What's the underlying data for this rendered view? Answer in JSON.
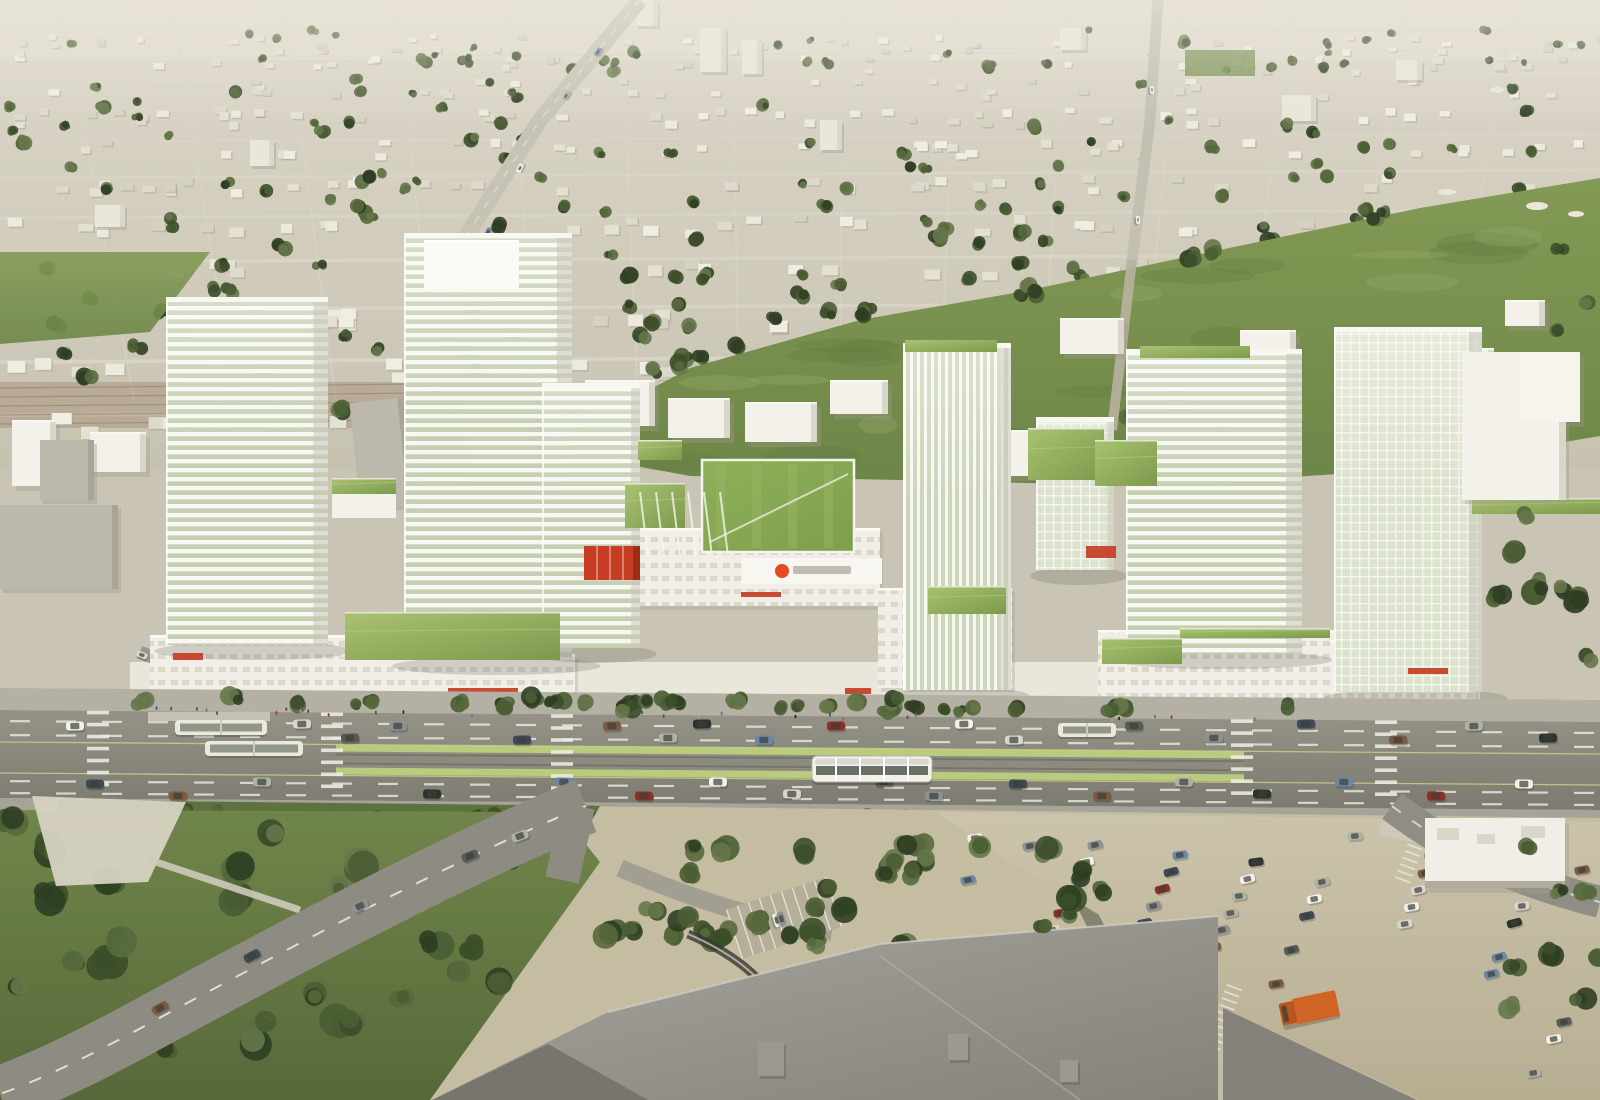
{
  "scene": {
    "description": "Aerial architectural rendering of a proposed transit-oriented mixed-use development: white wireframe towers with green roofs along an arterial road with a light-rail median, suburban fabric and greenbelt behind, surface parking and a large mall roof in the foreground",
    "width": 1600,
    "height": 1100
  },
  "palette": {
    "horizon": "#e0dbcd",
    "suburb_top": "#dcd7c9",
    "suburb_bottom": "#c7c2b0",
    "street": "#d9d5c7",
    "house_fills": [
      "#eceadd",
      "#e4e1d2",
      "#dedacb",
      "#f0eee2",
      "#d6d2c2"
    ],
    "house_shadow": "#a39d8e",
    "tree_greens": [
      "#2f3e22",
      "#3c4e2a",
      "#4a5d33",
      "#57693c",
      "#65774a"
    ],
    "field_top": "#839a55",
    "field_bottom": "#6d8547",
    "field_mottle_dark": "#5f7a3e",
    "field_mottle_light": "#95aa66",
    "bunker": "#eae7d9",
    "white_building": "#f3f1ea",
    "building_shade": "#d9d6ca",
    "building_shadow": "#9f9a8b",
    "gray_slab": "#bcb8ac",
    "rowhouse_brown": "#9b8068",
    "frame_white": "#f8f7f2",
    "glass_band": "#c5d0b2",
    "glass_band_v": "#ccd6ba",
    "glass_grid_bg": "#dce3cc",
    "podium_window": "#dbd7c9",
    "green_roof_light": "#a9c272",
    "green_roof_dark": "#7d9a4c",
    "lawn_bright": "#86a654",
    "lawn_stripe": "#97b563",
    "accent_red": "#c63d24",
    "logo_red": "#e8481f",
    "logo_text_gray": "#b9b6ac",
    "sidewalk": "#b4b1a4",
    "road_top": "#959387",
    "road_bottom": "#7d7b71",
    "lane_dash": "#edebe0",
    "lane_yellow": "#cdd287",
    "median_green": "#b9cb7e",
    "track_dark": "#76746a",
    "tram_body": "#f2f1ec",
    "tram_window": "#6b7066",
    "bus_body": "#ebe9dc",
    "car_colors": [
      "#f2f1ea",
      "#d8d6cc",
      "#5a5c58",
      "#8e9193",
      "#3f4a56",
      "#7e5a42",
      "#aeb3a6",
      "#2e3330",
      "#6b89a6",
      "#8c2f24"
    ],
    "people_colors": [
      "#555550",
      "#77736b",
      "#8c3a30",
      "#3a5a78",
      "#a8a49a",
      "#2e2c28"
    ],
    "park_top": "#70854a",
    "park_bottom": "#57693a",
    "plaza": "#d7d2c2",
    "ground_tan": "#c5bda2",
    "parking_light": "#cbc4ab",
    "parking_dark": "#b7ae92",
    "stall_line": "#efece0",
    "mall_roof_light": "#a8a59e",
    "mall_roof_dark": "#84827b",
    "mall_roof_darker": "#77756e",
    "truck_orange": "#d06427",
    "truck_cab": "#b9551e",
    "retail_roof": "#f0eee6",
    "shadow": "#5c5a4e"
  },
  "suburb": {
    "seed": 11,
    "h_streets": [
      38,
      58,
      82,
      110,
      142,
      178,
      218,
      262,
      310,
      362,
      415
    ],
    "v_street_spacing": 112,
    "house_count": 430,
    "tree_count": 250,
    "arterial": "M640,0 L540,120 L470,230 L430,310",
    "north_road": "M1158,0 L1150,120 L1132,260 L1112,430",
    "slabs": [
      [
        700,
        28,
        26,
        44
      ],
      [
        742,
        40,
        20,
        34
      ],
      [
        250,
        140,
        24,
        26
      ],
      [
        95,
        205,
        30,
        22
      ],
      [
        636,
        0,
        22,
        26
      ],
      [
        1282,
        95,
        34,
        26
      ],
      [
        1396,
        60,
        26,
        20
      ],
      [
        820,
        120,
        22,
        30
      ],
      [
        1060,
        28,
        26,
        22
      ]
    ],
    "rowhouse_band": [
      0,
      382,
      430,
      46
    ],
    "arterial_cars": [
      [
        598,
        52
      ],
      [
        566,
        96
      ],
      [
        520,
        168
      ],
      [
        488,
        232
      ]
    ],
    "north_road_cars": [
      [
        1152,
        90
      ],
      [
        1138,
        220
      ]
    ]
  },
  "greenfield": {
    "main_poly": [
      [
        540,
        448
      ],
      [
        690,
        368
      ],
      [
        860,
        320
      ],
      [
        1020,
        292
      ],
      [
        1210,
        252
      ],
      [
        1420,
        208
      ],
      [
        1600,
        178
      ],
      [
        1600,
        436
      ],
      [
        1400,
        470
      ],
      [
        1150,
        486
      ],
      [
        900,
        480
      ],
      [
        690,
        476
      ]
    ],
    "left_poly": [
      [
        0,
        252
      ],
      [
        210,
        252
      ],
      [
        150,
        332
      ],
      [
        0,
        344
      ]
    ],
    "bunkers": [
      [
        1447,
        192,
        9,
        3
      ],
      [
        1537,
        206,
        11,
        4
      ],
      [
        1576,
        214,
        8,
        3
      ],
      [
        1497,
        90,
        7,
        3
      ]
    ],
    "mottle_seed": 5,
    "tree_line": [
      [
        560,
        430
      ],
      [
        700,
        360
      ],
      [
        860,
        316
      ],
      [
        1030,
        288
      ],
      [
        1200,
        254
      ],
      [
        1380,
        218
      ]
    ],
    "inner_clusters": [
      [
        1080,
        430
      ],
      [
        1130,
        415
      ],
      [
        1180,
        400
      ],
      [
        1215,
        425
      ],
      [
        1560,
        250
      ],
      [
        1585,
        300
      ],
      [
        1560,
        330
      ],
      [
        1100,
        455
      ]
    ],
    "park_patch": [
      1185,
      50,
      70,
      26
    ]
  },
  "campus": {
    "white_buildings": [
      [
        585,
        380,
        70,
        46
      ],
      [
        668,
        398,
        62,
        40
      ],
      [
        745,
        402,
        72,
        40
      ],
      [
        830,
        380,
        58,
        34
      ],
      [
        925,
        352,
        66,
        34
      ],
      [
        1000,
        430,
        70,
        46
      ],
      [
        1060,
        318,
        64,
        36
      ],
      [
        1240,
        330,
        56,
        30
      ],
      [
        1430,
        348,
        64,
        52
      ],
      [
        1505,
        300,
        40,
        26
      ],
      [
        90,
        432,
        56,
        40
      ],
      [
        12,
        420,
        44,
        66
      ],
      [
        1520,
        352,
        60,
        70
      ]
    ],
    "gray_slabs": [
      [
        355,
        400,
        54,
        108
      ],
      [
        418,
        396,
        46,
        96
      ],
      [
        0,
        505,
        118,
        84
      ],
      [
        40,
        440,
        54,
        60
      ]
    ]
  },
  "development": {
    "towers": [
      {
        "id": "tower-1",
        "x": 166,
        "y": 300,
        "w": 162,
        "h": 345,
        "style": "h"
      },
      {
        "id": "tower-2",
        "x": 404,
        "y": 236,
        "w": 168,
        "h": 424,
        "style": "h",
        "parapet": [
          424,
          240,
          95,
          48
        ]
      },
      {
        "id": "tower-3",
        "x": 542,
        "y": 386,
        "w": 98,
        "h": 262,
        "style": "h"
      },
      {
        "id": "tower-4",
        "x": 903,
        "y": 346,
        "w": 108,
        "h": 344,
        "style": "v",
        "cap": [
          905,
          340,
          92,
          12
        ]
      },
      {
        "id": "tower-5",
        "x": 1036,
        "y": 420,
        "w": 78,
        "h": 150,
        "style": "grid"
      },
      {
        "id": "tower-6",
        "x": 1126,
        "y": 352,
        "w": 176,
        "h": 302,
        "style": "h",
        "cap": [
          1140,
          346,
          110,
          12
        ]
      },
      {
        "id": "tower-7",
        "x": 1334,
        "y": 330,
        "w": 148,
        "h": 362,
        "style": "grid"
      }
    ],
    "podiums": [
      [
        150,
        635,
        205,
        70
      ],
      [
        340,
        654,
        235,
        50
      ],
      [
        628,
        528,
        252,
        78
      ],
      [
        878,
        588,
        134,
        100
      ],
      [
        1098,
        630,
        238,
        72
      ],
      [
        1330,
        640,
        145,
        60
      ]
    ],
    "green_roofs": [
      [
        332,
        478,
        64,
        16
      ],
      [
        345,
        612,
        215,
        48
      ],
      [
        625,
        483,
        60,
        45
      ],
      [
        638,
        440,
        44,
        20
      ],
      [
        928,
        586,
        78,
        28
      ],
      [
        1102,
        638,
        80,
        26
      ],
      [
        1180,
        628,
        150,
        10
      ],
      [
        1472,
        498,
        128,
        16
      ],
      [
        1028,
        428,
        76,
        52
      ],
      [
        1095,
        440,
        62,
        46
      ]
    ],
    "small_green_bldg": [
      332,
      478,
      64,
      40
    ],
    "lawn_main": [
      702,
      460,
      152,
      92
    ],
    "annex": [
      1462,
      352,
      104,
      148
    ],
    "annex2": [
      1520,
      352,
      60,
      70
    ],
    "logo": {
      "cx": 782,
      "cy": 571,
      "r": 7,
      "bar": [
        793,
        566,
        58,
        8
      ]
    },
    "facade_band": [
      742,
      558,
      140,
      26
    ],
    "red_canopy": [
      584,
      546,
      56,
      34
    ],
    "red_signs": [
      [
        173,
        653,
        30,
        7
      ],
      [
        448,
        688,
        70,
        6
      ],
      [
        845,
        688,
        26,
        6
      ],
      [
        1086,
        546,
        30,
        12
      ],
      [
        1408,
        668,
        40,
        6
      ],
      [
        741,
        592,
        40,
        5
      ]
    ],
    "street_trees": {
      "seed": 21,
      "count": 42,
      "x1": 140,
      "x2": 1390,
      "y": 700
    },
    "people": {
      "seed": 22,
      "count": 30,
      "x1": 150,
      "x2": 1380,
      "y": 706
    },
    "local_street": "M140,652 L258,702"
  },
  "road": {
    "sidewalk_north": [
      [
        0,
        688
      ],
      [
        1600,
        700
      ],
      [
        1600,
        722
      ],
      [
        0,
        710
      ]
    ],
    "band": [
      [
        0,
        710
      ],
      [
        1600,
        722
      ],
      [
        1600,
        810
      ],
      [
        0,
        798
      ]
    ],
    "sidewalk_south": [
      [
        0,
        798
      ],
      [
        1600,
        810
      ],
      [
        1600,
        822
      ],
      [
        0,
        810
      ]
    ],
    "median": {
      "x": 336,
      "y": 748,
      "w": 908,
      "h": 30,
      "tilt": 0.0075
    },
    "crosswalk_xs": [
      98,
      332,
      562,
      1242,
      1386
    ],
    "dash_rows": [
      726,
      740,
      786,
      798
    ],
    "yellow_lines": [
      748,
      779
    ],
    "cars_west": [
      [
        75,
        726
      ],
      [
        302,
        724
      ],
      [
        350,
        738
      ],
      [
        398,
        726
      ],
      [
        522,
        740
      ],
      [
        612,
        726
      ],
      [
        668,
        738
      ],
      [
        702,
        724
      ],
      [
        764,
        740
      ],
      [
        836,
        726
      ],
      [
        964,
        724
      ],
      [
        1014,
        740
      ],
      [
        1134,
        726
      ],
      [
        1214,
        738
      ],
      [
        1306,
        724
      ],
      [
        1398,
        740
      ],
      [
        1474,
        726
      ],
      [
        1548,
        738
      ]
    ],
    "cars_east": [
      [
        95,
        784
      ],
      [
        178,
        796
      ],
      [
        262,
        782
      ],
      [
        432,
        794
      ],
      [
        564,
        782
      ],
      [
        644,
        796
      ],
      [
        718,
        782
      ],
      [
        792,
        794
      ],
      [
        884,
        782
      ],
      [
        934,
        796
      ],
      [
        1018,
        784
      ],
      [
        1102,
        796
      ],
      [
        1184,
        782
      ],
      [
        1262,
        794
      ],
      [
        1344,
        782
      ],
      [
        1436,
        796
      ],
      [
        1524,
        784
      ]
    ],
    "tram": {
      "x": 812,
      "y": 756,
      "w": 120,
      "h": 26,
      "segments": 5
    },
    "buses": [
      [
        175,
        720,
        92,
        15
      ],
      [
        205,
        741,
        98,
        15
      ],
      [
        1058,
        723,
        58,
        14
      ]
    ],
    "platform": [
      148,
      712,
      122,
      9
    ]
  },
  "south_band": {
    "poly": [
      [
        58,
        800
      ],
      [
        620,
        806
      ],
      [
        1118,
        816
      ],
      [
        1118,
        840
      ],
      [
        620,
        832
      ],
      [
        58,
        828
      ]
    ],
    "tree_seed": 31,
    "tree_count": 30
  },
  "foreground": {
    "ground_poly": [
      [
        600,
        806
      ],
      [
        1600,
        818
      ],
      [
        1600,
        1100
      ],
      [
        430,
        1100
      ]
    ],
    "park_poly": [
      [
        0,
        810
      ],
      [
        560,
        812
      ],
      [
        600,
        862
      ],
      [
        430,
        1100
      ],
      [
        0,
        1100
      ]
    ],
    "park_tree_seed": 41,
    "park_tree_count": 30,
    "plaza_poly": [
      [
        32,
        796
      ],
      [
        186,
        802
      ],
      [
        148,
        882
      ],
      [
        56,
        886
      ]
    ],
    "plaza_path": "M150,860 L300,910",
    "curve_road": "M586,806 C470,852 300,942 152,1022 C90,1056 40,1080 0,1094",
    "stub_road": "M578,806 L562,880",
    "curve_cars": [
      [
        470,
        856,
        -22
      ],
      [
        360,
        906,
        -26
      ],
      [
        252,
        956,
        -28
      ],
      [
        160,
        1008,
        -30
      ],
      [
        520,
        836,
        -20
      ]
    ],
    "driveway": "M620,868 C700,902 760,920 832,932",
    "ramp_dark": "M688,934 C730,952 762,976 776,1004",
    "small_lot": {
      "rect": [
        732,
        892,
        104,
        52
      ],
      "angle": -18,
      "stalls": 9,
      "cars": 4,
      "seed": 51
    },
    "mid_trees": {
      "seed": 61,
      "count": 26,
      "cx": 740,
      "cy": 900,
      "rx": 180,
      "ry": 55
    },
    "dark_drive": "M1058,850 L1100,935",
    "tree_clusters": [
      [
        1065,
        890,
        40,
        60,
        6
      ],
      [
        1560,
        920,
        50,
        90,
        8
      ],
      [
        1500,
        560,
        40,
        50,
        5
      ],
      [
        1580,
        620,
        30,
        40,
        4
      ],
      [
        940,
        860,
        60,
        30,
        5
      ]
    ],
    "parking_poly": [
      [
        935,
        812
      ],
      [
        1600,
        822
      ],
      [
        1600,
        1100
      ],
      [
        1420,
        1100
      ],
      [
        1223,
        1008
      ],
      [
        1128,
        932
      ],
      [
        1010,
        862
      ]
    ],
    "parking_rows": [
      {
        "x": 1095,
        "y": 845,
        "dx": -0.5,
        "dy": 1,
        "n": 8
      },
      {
        "x": 1180,
        "y": 855,
        "dx": -0.52,
        "dy": 1,
        "n": 9
      },
      {
        "x": 1256,
        "y": 862,
        "dx": -0.5,
        "dy": 1,
        "n": 9
      },
      {
        "x": 1322,
        "y": 882,
        "dx": -0.45,
        "dy": 1,
        "n": 7
      },
      {
        "x": 1432,
        "y": 856,
        "dx": -0.4,
        "dy": 1,
        "n": 5
      },
      {
        "x": 1522,
        "y": 906,
        "dx": -0.45,
        "dy": 1,
        "n": 6
      },
      {
        "x": 1564,
        "y": 1022,
        "dx": -0.6,
        "dy": 1,
        "n": 4
      }
    ],
    "row_step": 17,
    "parked_seed": 81,
    "loose_cars": [
      [
        975,
        838,
        -8
      ],
      [
        1030,
        846,
        -10
      ],
      [
        1355,
        836,
        -6
      ],
      [
        1440,
        838,
        -8
      ],
      [
        1520,
        846,
        -6
      ],
      [
        1582,
        870,
        -10
      ],
      [
        968,
        880,
        -12
      ]
    ],
    "stall_groups": [
      [
        1395,
        878,
        10,
        -70
      ],
      [
        1200,
        1058,
        12,
        -70
      ],
      [
        1048,
        1006,
        10,
        -70
      ]
    ],
    "truck": {
      "x": 1278,
      "y": 1002,
      "w": 58,
      "h": 26,
      "angle": -12
    },
    "red_car": [
      1246,
      1030
    ],
    "retail_box": [
      1425,
      818,
      140,
      70
    ],
    "retail_drive": "M1380,828 L1540,862",
    "right_road": "M1392,806 C1452,852 1520,882 1600,902",
    "mall_roof_main": [
      [
        432,
        1100
      ],
      [
        608,
        1012
      ],
      [
        880,
        944
      ],
      [
        1150,
        922
      ],
      [
        1218,
        916
      ],
      [
        1218,
        1100
      ]
    ],
    "mall_roof_right": [
      [
        1223,
        1008
      ],
      [
        1417,
        1100
      ],
      [
        1223,
        1100
      ]
    ],
    "mall_facet_line": [
      [
        880,
        956
      ],
      [
        1080,
        1100
      ]
    ],
    "mall_left_wedge": [
      [
        432,
        1100
      ],
      [
        548,
        1044
      ],
      [
        648,
        1100
      ]
    ],
    "roof_units": [
      [
        758,
        1042,
        26,
        34
      ],
      [
        948,
        1034,
        20,
        26
      ],
      [
        1060,
        1060,
        18,
        22
      ]
    ]
  }
}
